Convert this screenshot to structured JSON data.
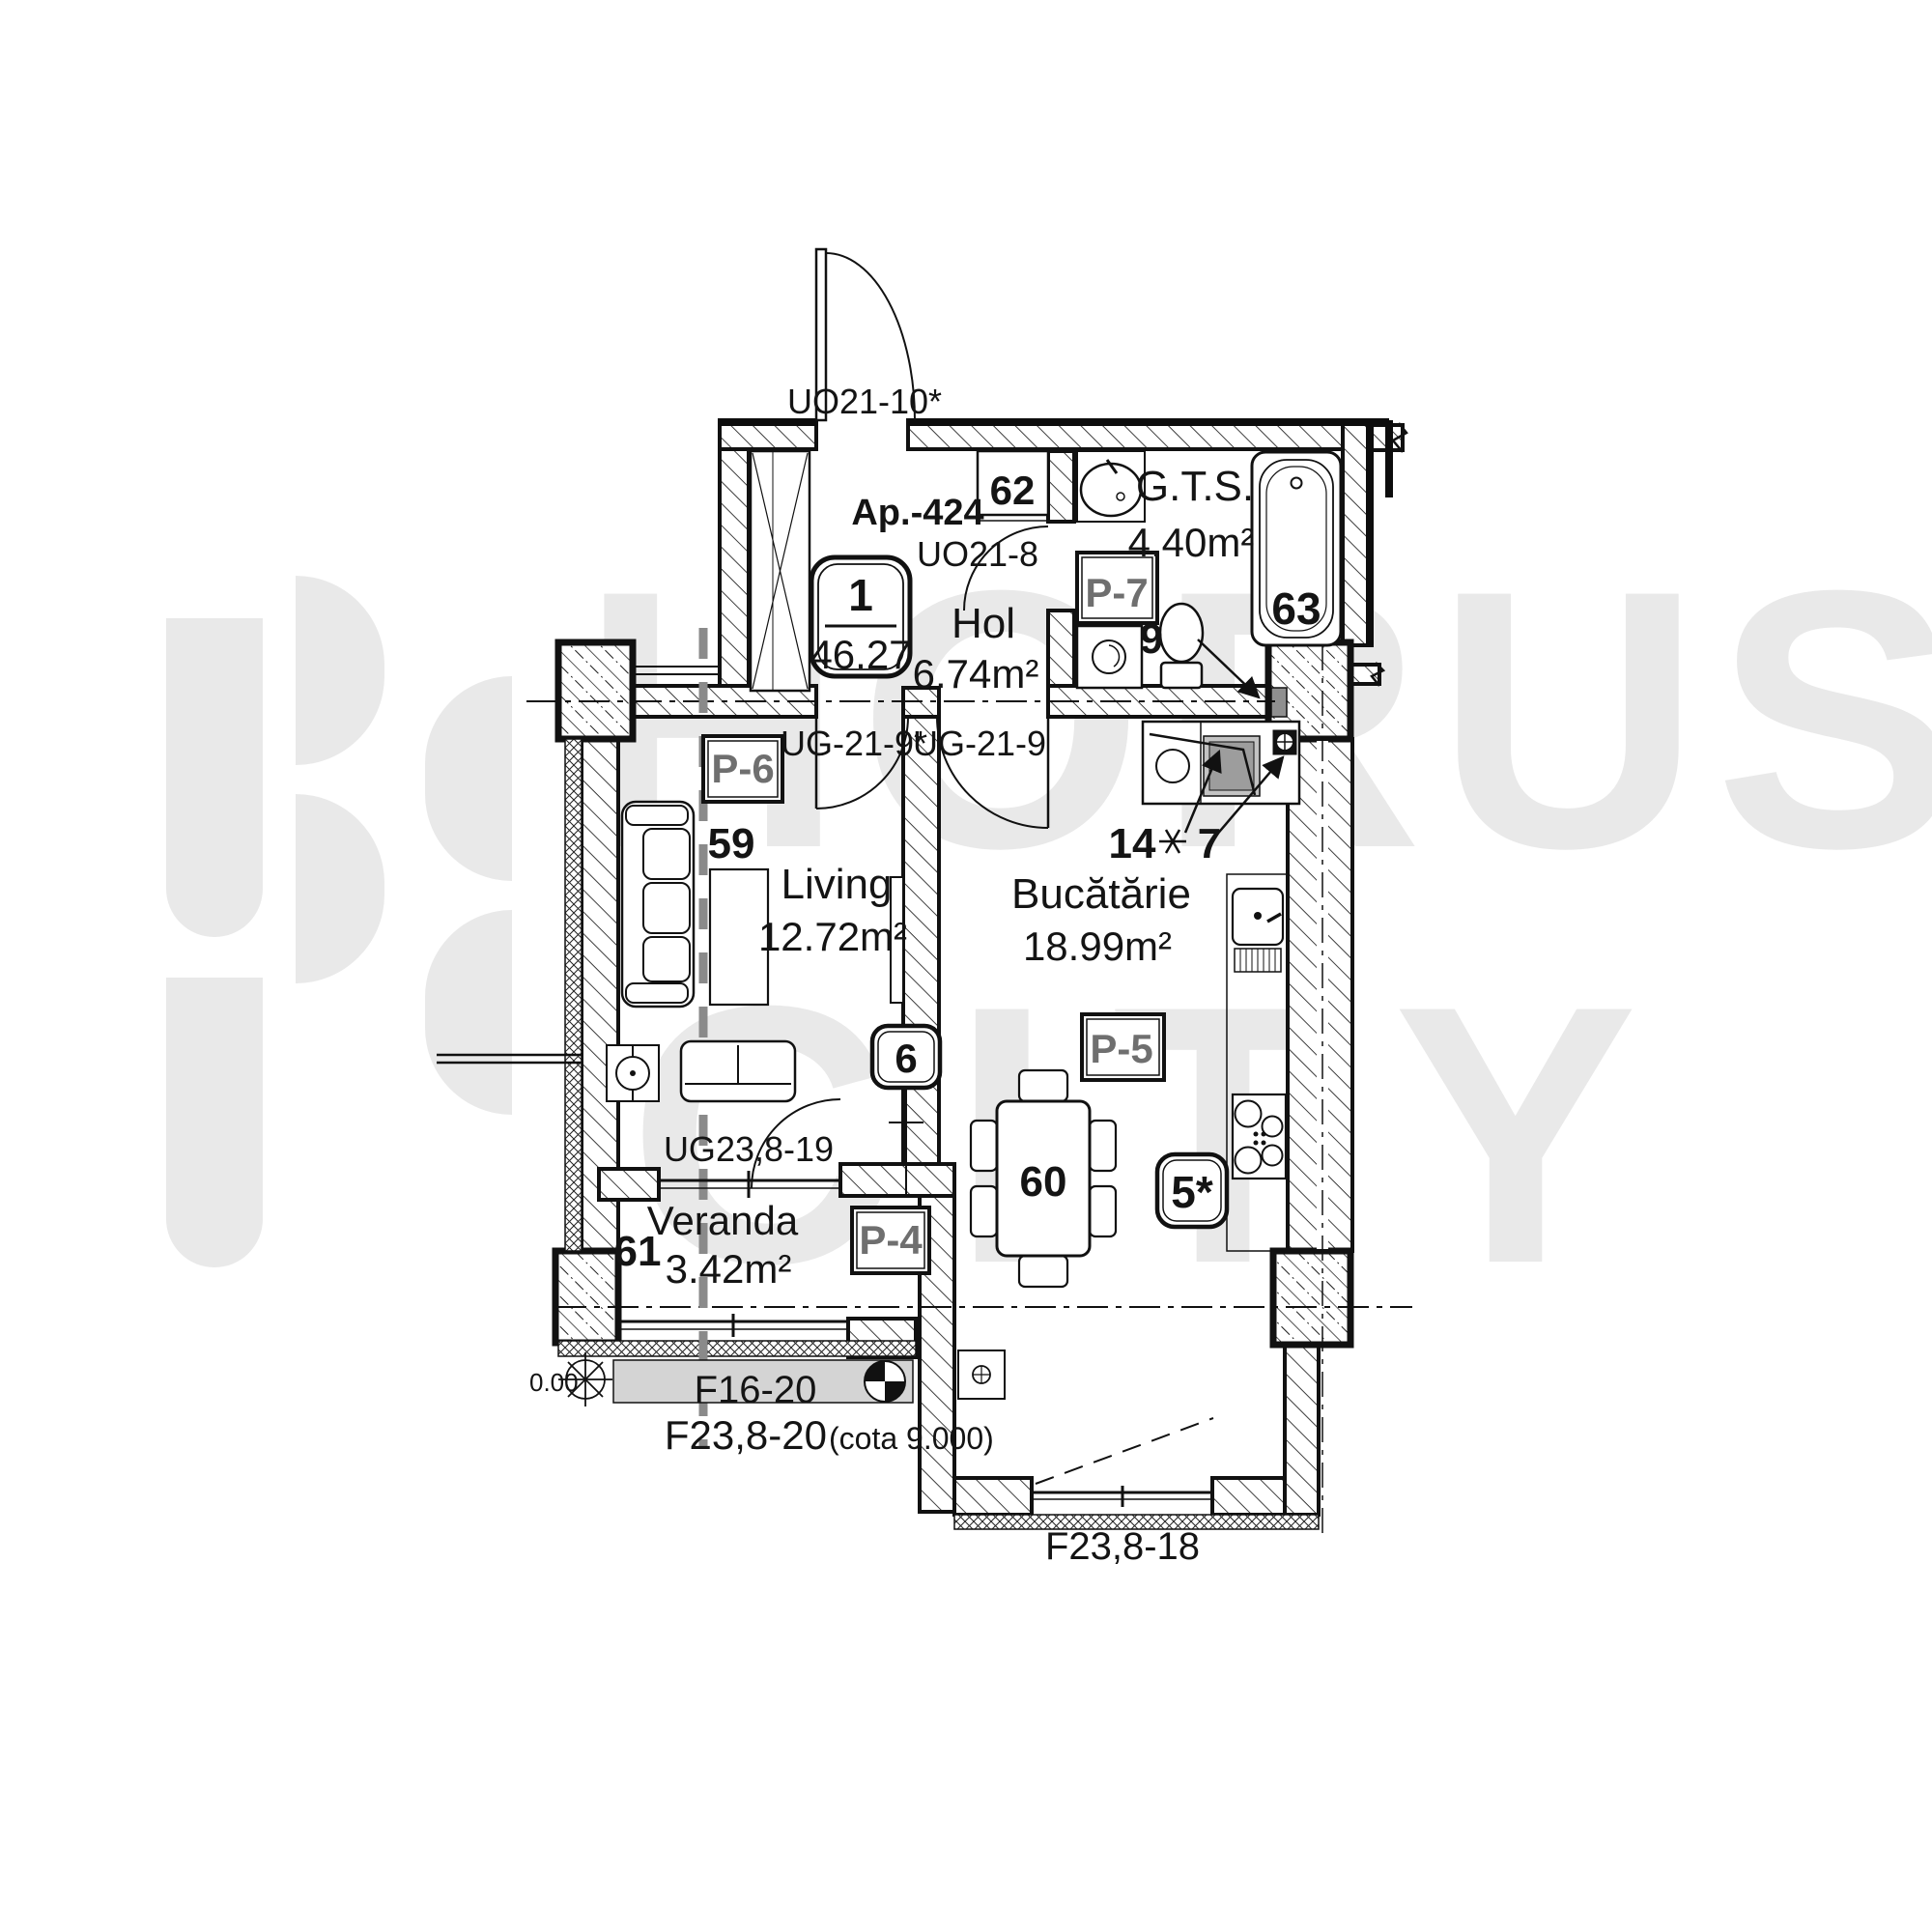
{
  "watermark": {
    "line1": "HORUS",
    "line2": "CITY"
  },
  "title": {
    "apartment": "Ap.-424",
    "badge_number": "1",
    "badge_area": "46.27"
  },
  "rooms": {
    "hol": {
      "name": "Hol",
      "area": "6.74m²"
    },
    "gts": {
      "name": "G.T.S.",
      "area": "4.40m²"
    },
    "living": {
      "name": "Living",
      "area": "12.72m²"
    },
    "bucatarie": {
      "name": "Bucătărie",
      "area": "18.99m²"
    },
    "veranda": {
      "name": "Veranda",
      "area": "3.42m²"
    }
  },
  "items": {
    "wardrobe": "62",
    "bathtub": "63",
    "toilet": "9",
    "living_zone": "59",
    "dining_table": "60",
    "veranda_zone": "61",
    "washer": "14",
    "socket": "7"
  },
  "badges": {
    "door": "6",
    "riser": "5*"
  },
  "panels": {
    "p4": "P-4",
    "p5": "P-5",
    "p6": "P-6",
    "p7": "P-7"
  },
  "openings": {
    "entrance": "UO21-10*",
    "bath_door": "UO21-8",
    "living_door": "UG-21-9*",
    "kitchen_door": "UG-21-9",
    "veranda_door": "UG23,8-19",
    "sill": "F16-20",
    "lower_window": "F23,8-20",
    "lower_window_note": "(cota 9.000)",
    "balcony_window": "F23,8-18",
    "level": "0.00"
  }
}
